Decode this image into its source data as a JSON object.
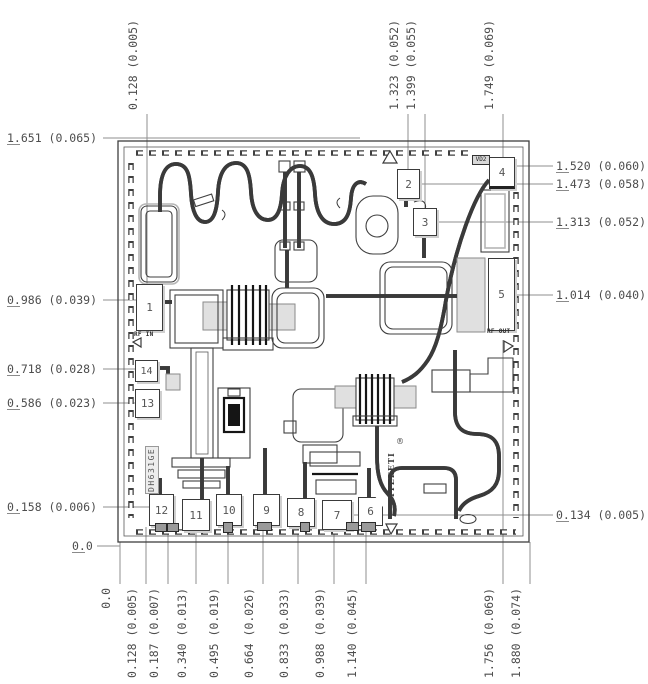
{
  "pads": [
    "1",
    "2",
    "3",
    "4",
    "5",
    "6",
    "7",
    "8",
    "9",
    "10",
    "11",
    "12",
    "13",
    "14"
  ],
  "die_text": {
    "rf_in": "RF IN",
    "rf_out": "RF OUT",
    "bias_tag": "VD2",
    "marking_part": "DH631GE",
    "marking_logo": "ITEEETI",
    "registered_mark": "®"
  },
  "dimensions": {
    "left": [
      "1.651 (0.065)",
      "0.986 (0.039)",
      "0.718 (0.028)",
      "0.586 (0.023)",
      "0.158 (0.006)",
      "0.0"
    ],
    "right": [
      "1.520 (0.060)",
      "1.473 (0.058)",
      "1.313 (0.052)",
      "1.014 (0.040)",
      "0.134 (0.005)"
    ],
    "top": [
      "0.128 (0.005)",
      "1.323 (0.052)",
      "1.399 (0.055)",
      "1.749 (0.069)"
    ],
    "bottom": [
      "0.0",
      "0.128 (0.005)",
      "0.187 (0.007)",
      "0.340 (0.013)",
      "0.495 (0.019)",
      "0.664 (0.026)",
      "0.833 (0.033)",
      "0.988 (0.039)",
      "1.140 (0.045)",
      "1.756 (0.069)",
      "1.880 (0.074)"
    ]
  },
  "colors": {
    "line": "#3f3f3f",
    "dimension_line": "#8f8f8f",
    "label_text": "#4d4d4d",
    "shade": "#cfcfcf",
    "background": "#ffffff"
  }
}
